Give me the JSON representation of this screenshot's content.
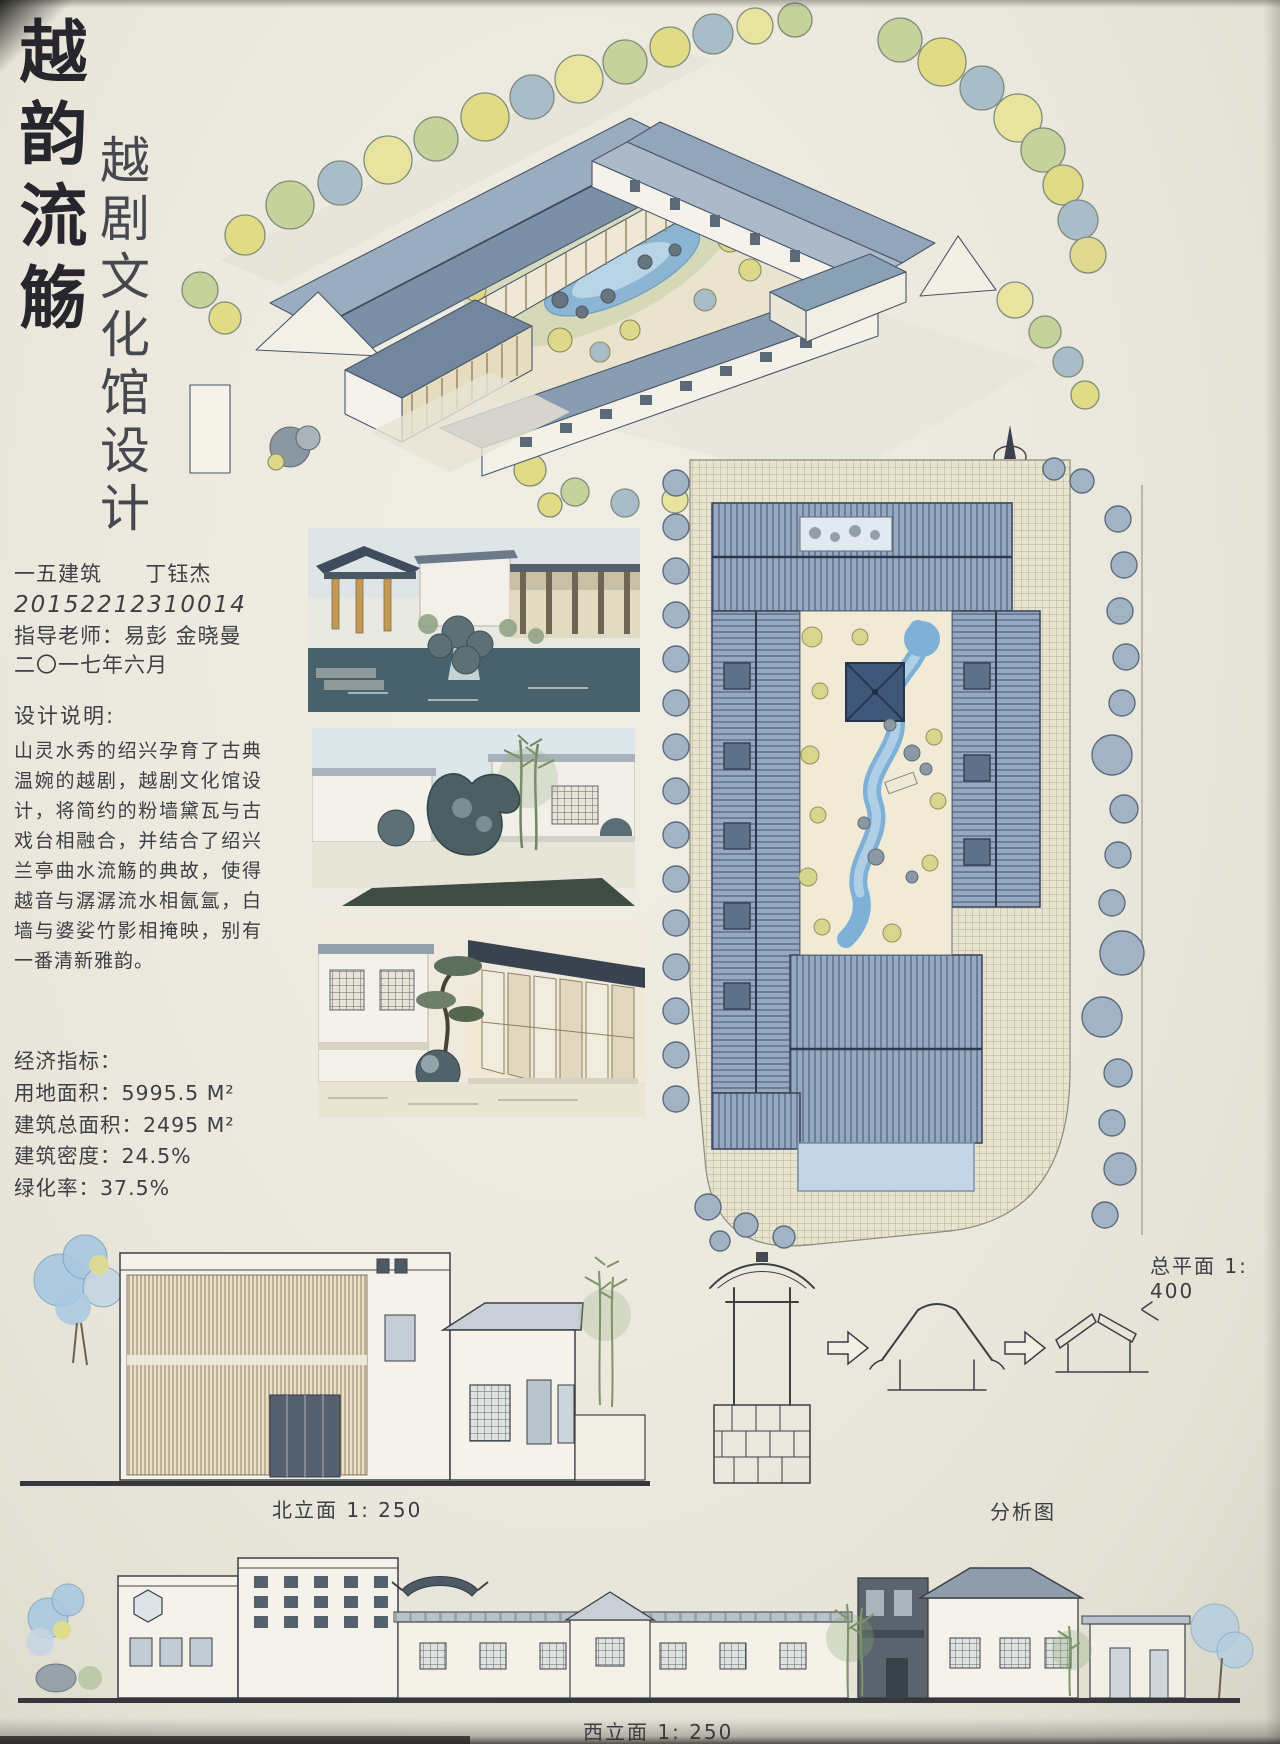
{
  "titles": {
    "main": "越韵流觞",
    "sub": "越剧文化馆设计"
  },
  "info": {
    "class_name": "一五建筑",
    "student": "丁钰杰",
    "student_id": "20152212310014",
    "advisor_line": "指导老师：易彭  金晓曼",
    "date": "二〇一七年六月"
  },
  "description": {
    "heading": "设计说明:",
    "body": "山灵水秀的绍兴孕育了古典温婉的越剧，越剧文化馆设计，将简约的粉墙黛瓦与古戏台相融合，并结合了绍兴兰亭曲水流觞的典故，使得越音与潺潺流水相氤氲，白墙与婆娑竹影相掩映，别有一番清新雅韵。"
  },
  "indicators": {
    "heading": "经济指标：",
    "items": [
      "用地面积：5995.5 M²",
      "建筑总面积：2495 M²",
      "建筑密度：24.5%",
      "绿化率：37.5%"
    ]
  },
  "labels": {
    "site_plan": "总平面 1: 400",
    "north_elevation": "北立面 1: 250",
    "analysis": "分析图",
    "west_elevation": "西立面 1: 250"
  },
  "colors": {
    "paper": "#ebe8dd",
    "ink": "#36383e",
    "roof_blue": "#8ea1b6",
    "roof_blue_dark": "#64748c",
    "water": "#7fafd4",
    "foliage_yellow": "#ded88a",
    "foliage_green": "#c7d19b",
    "foliage_blue": "#a9bcca",
    "pavilion_dark": "#3f5779"
  },
  "icons": {
    "north_arrow": "obelisk-compass-pointer",
    "flow_arrow": "hollow-block-arrow-right"
  }
}
